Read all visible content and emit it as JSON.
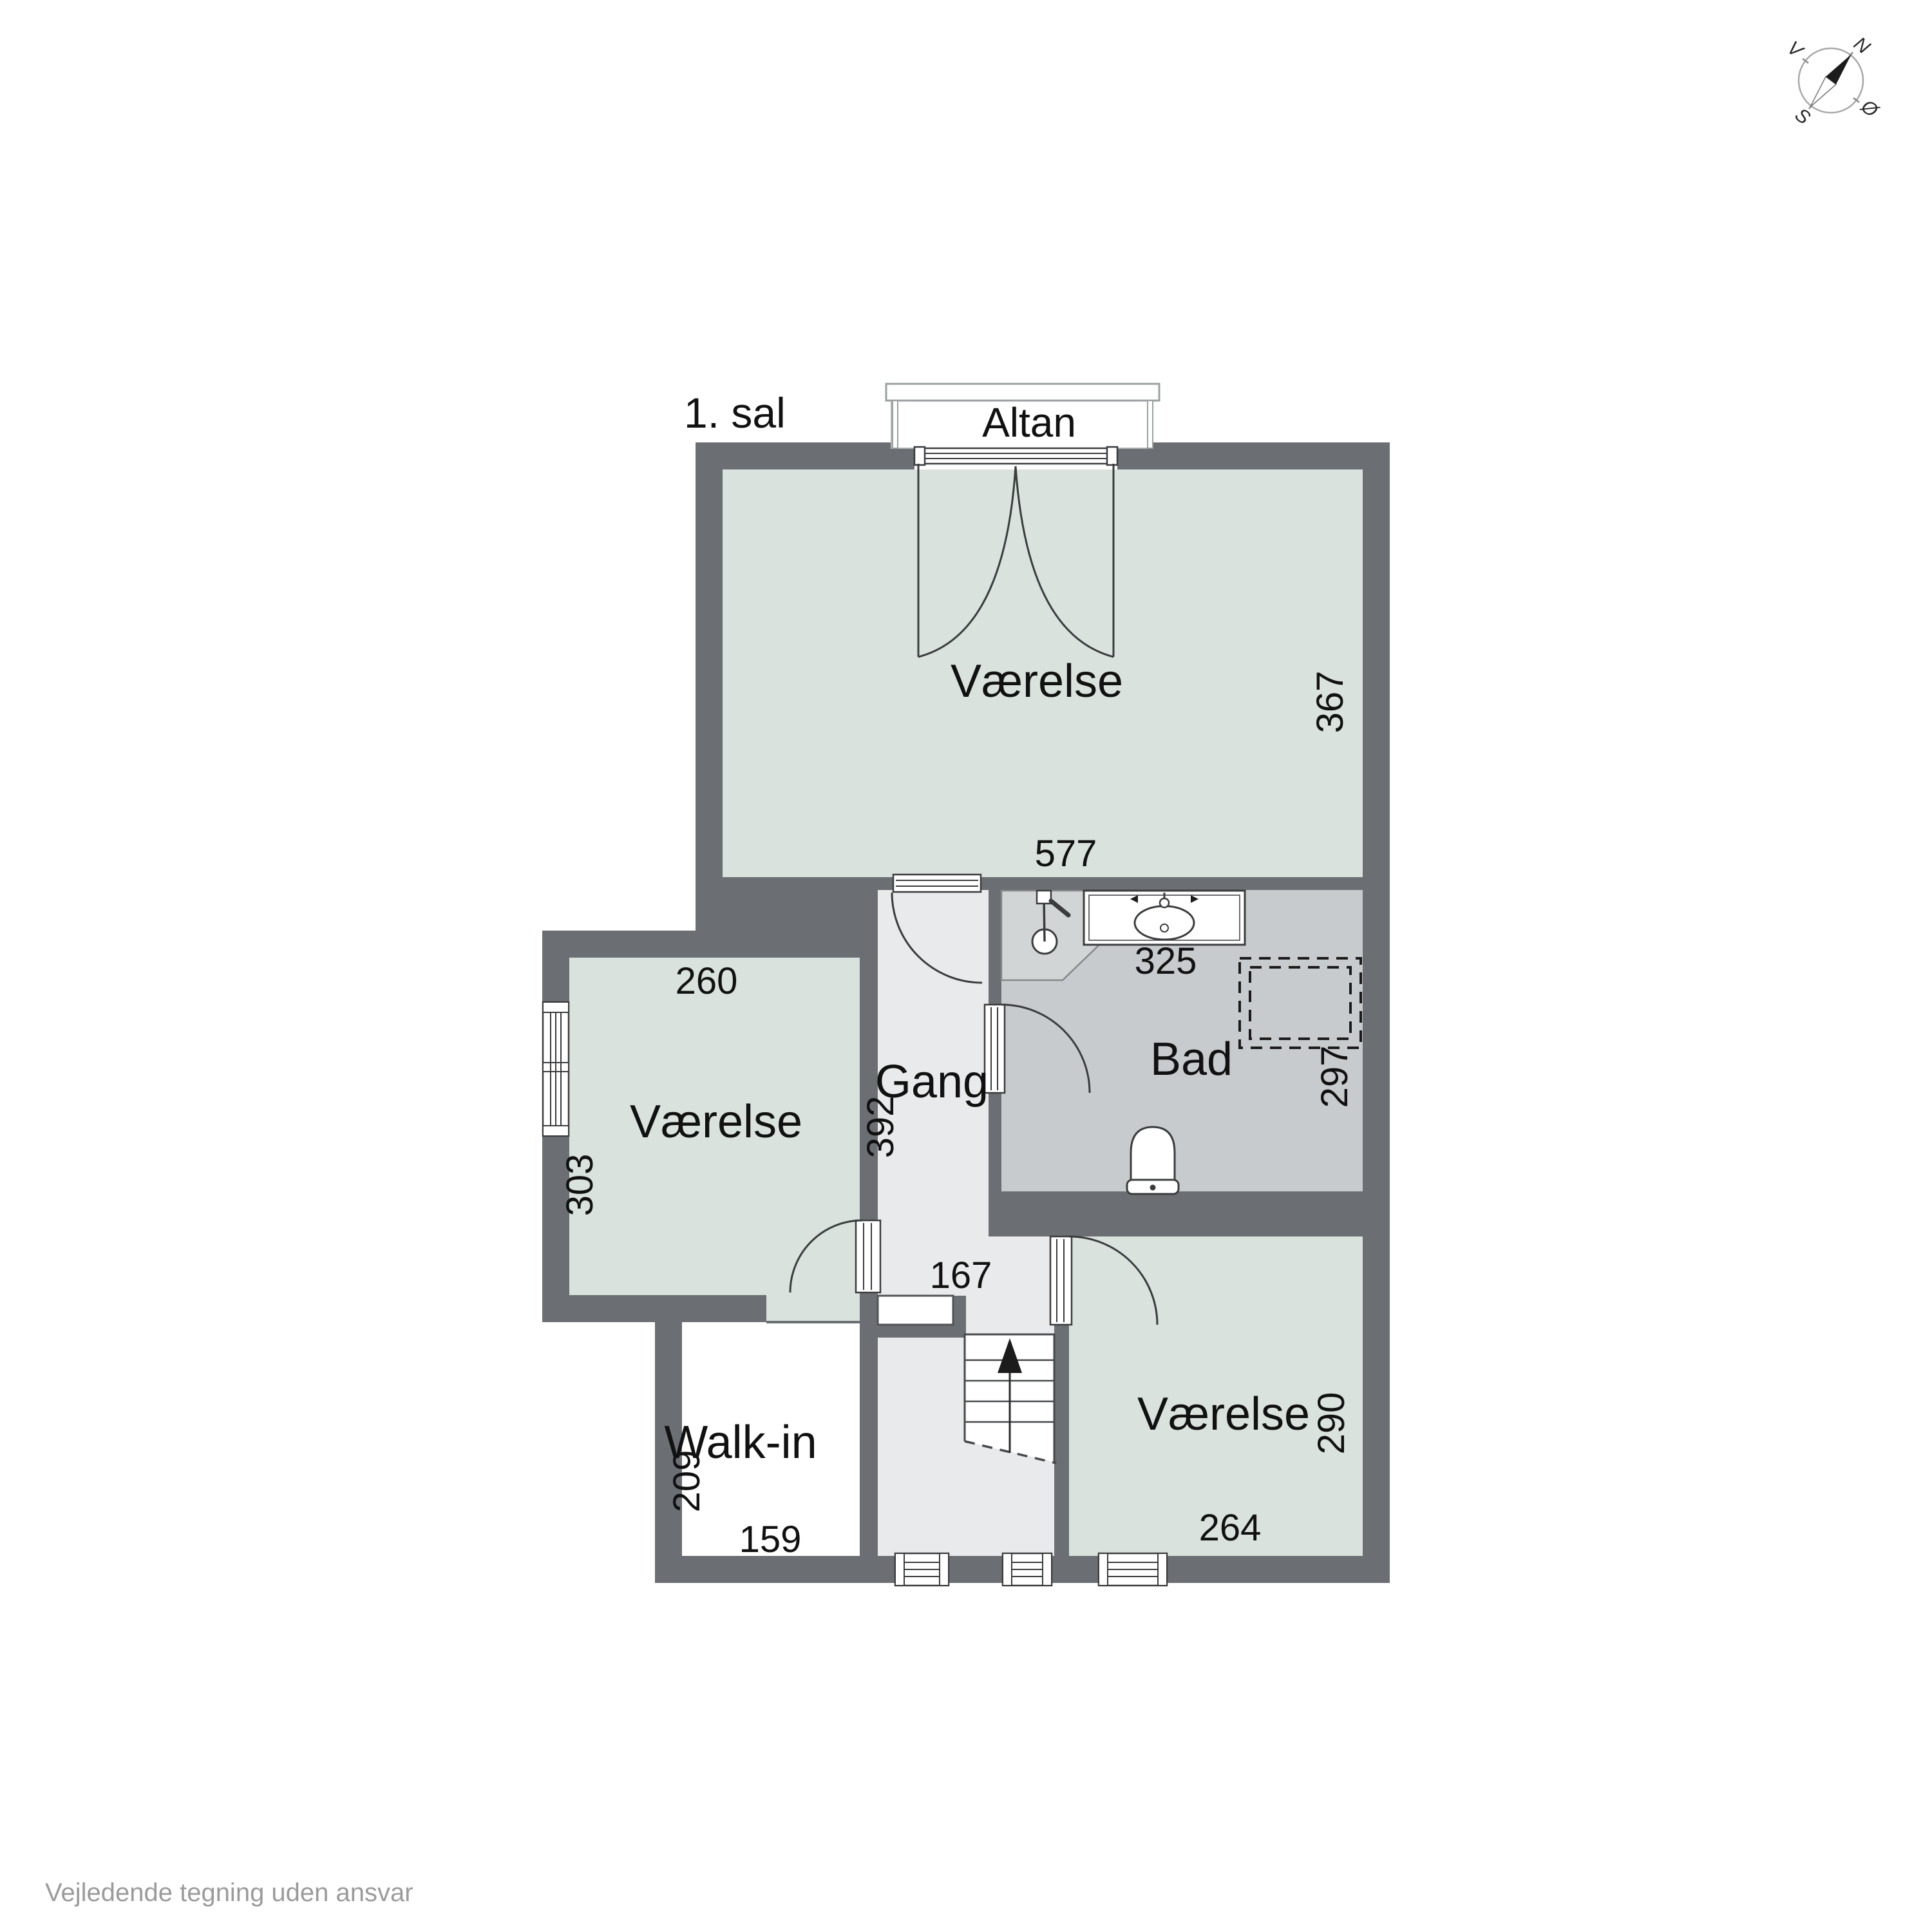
{
  "header": {
    "floor_label": "1. sal"
  },
  "balcony": {
    "label": "Altan"
  },
  "rooms": {
    "main": {
      "label": "Værelse",
      "w": "577",
      "h": "367"
    },
    "left": {
      "label": "Værelse",
      "w": "260",
      "h": "303"
    },
    "hallway": {
      "label": "Gang",
      "l": "392",
      "w": "167"
    },
    "bath": {
      "label": "Bad",
      "w": "325",
      "h": "297"
    },
    "walkin": {
      "label": "Walk-in",
      "w": "159",
      "h": "209"
    },
    "bottom": {
      "label": "Værelse",
      "w": "264",
      "h": "290"
    }
  },
  "compass": {
    "north": "N",
    "east": "Ø",
    "south": "S",
    "west": "V"
  },
  "footer": {
    "disclaimer": "Vejledende tegning uden ansvar"
  },
  "colors": {
    "wall": "#6b6f73",
    "room_fill": "#d9e2dc",
    "hallway_fill": "#e8eaeb",
    "bath_fill": "#c8cbcd",
    "shower_fill": "#d2d5d6",
    "text": "#111111",
    "footer_text": "#9b9b9b"
  }
}
